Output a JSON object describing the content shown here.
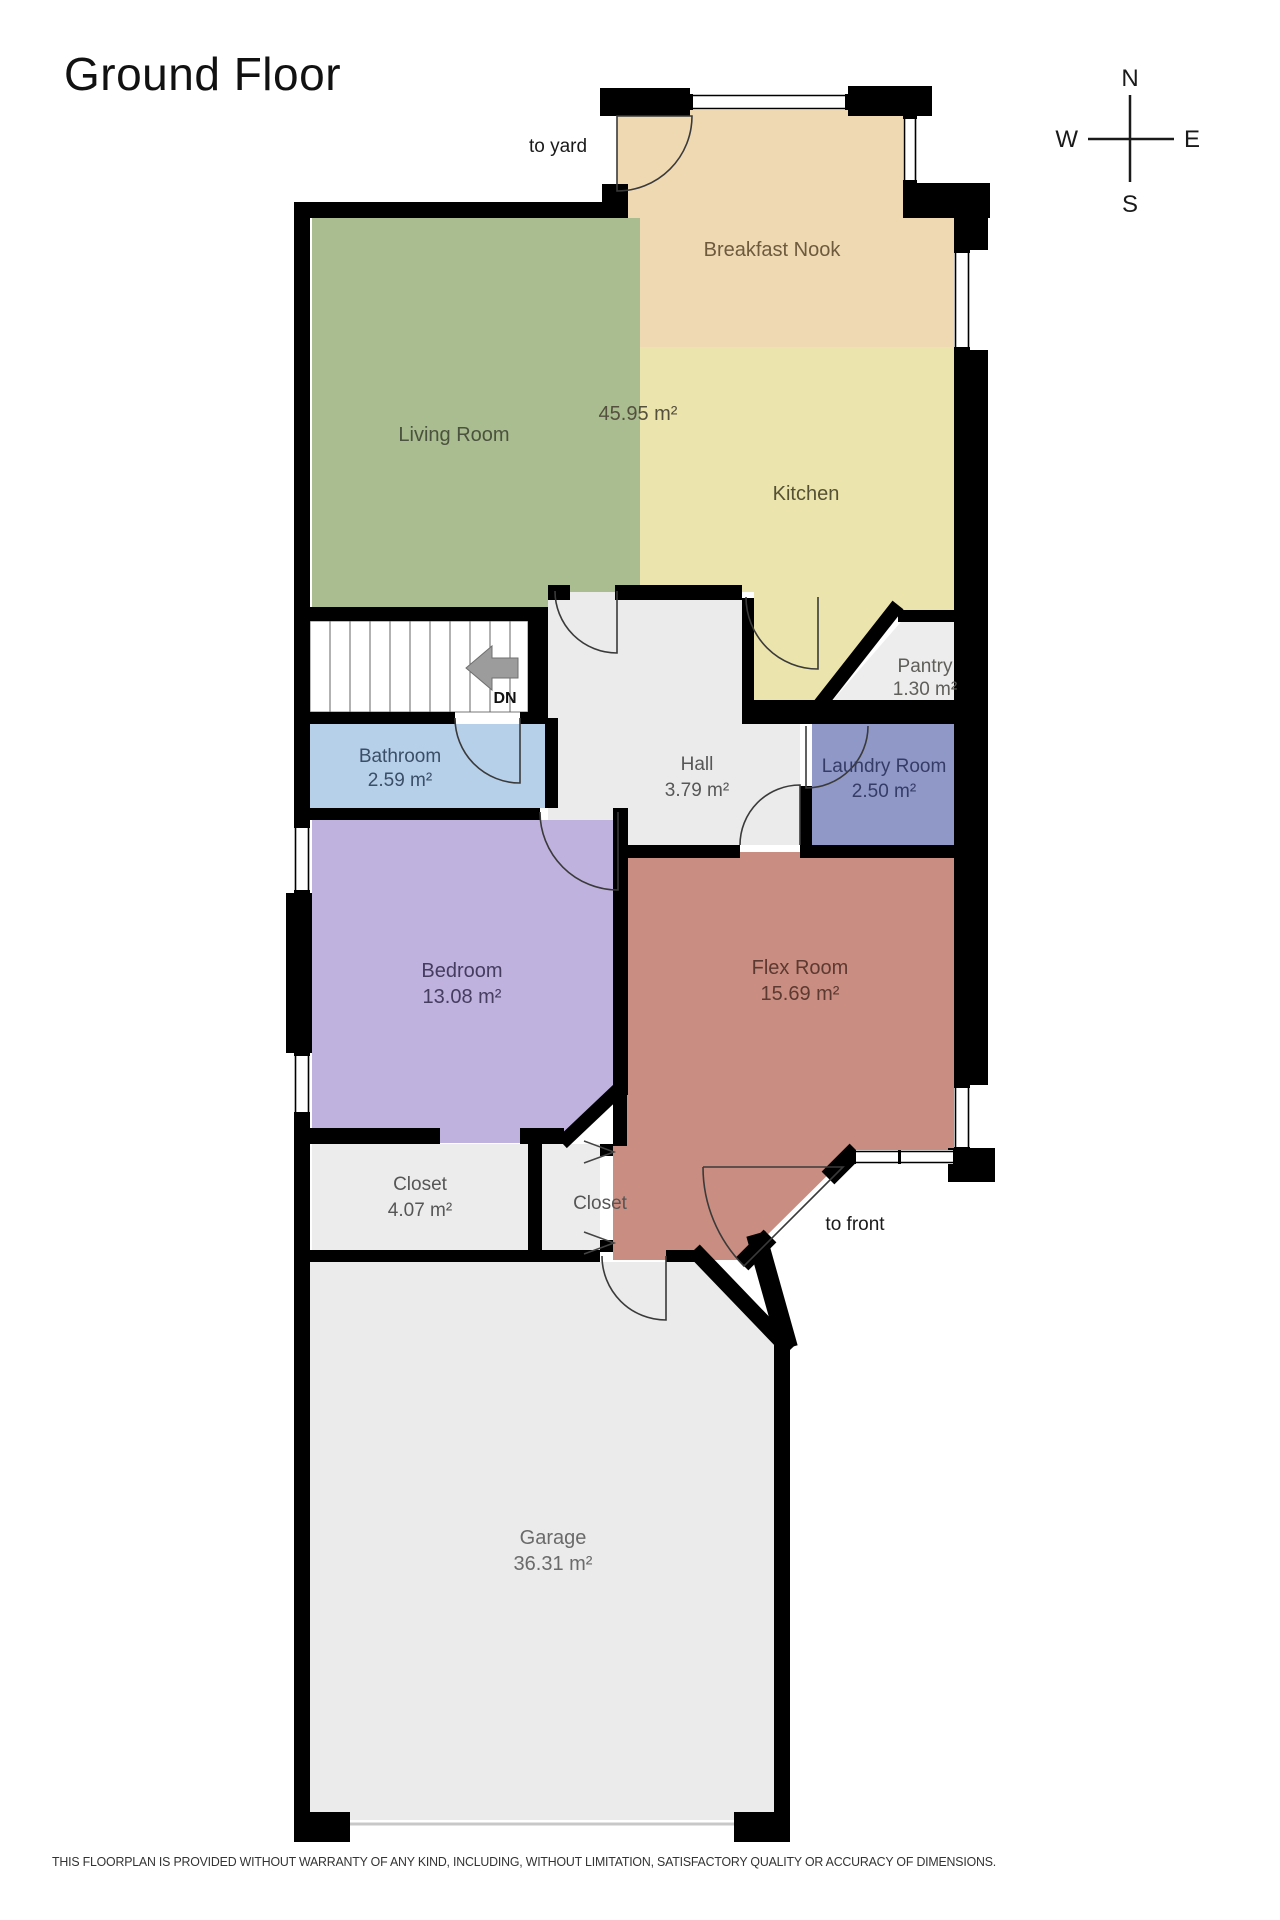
{
  "title": "Ground Floor",
  "compass": {
    "north": "N",
    "east": "E",
    "south": "S",
    "west": "W"
  },
  "annotations": {
    "to_yard": "to yard",
    "to_front": "to front"
  },
  "stairs": {
    "direction_label": "DN"
  },
  "living_kitchen_area": {
    "label": "45.95 m²",
    "color": "#55503e"
  },
  "rooms": [
    {
      "name": "Breakfast Nook",
      "area": "",
      "fill": "#eed9b3",
      "label_color": "#6e5a3d"
    },
    {
      "name": "Living Room",
      "area": "",
      "fill": "#a9bd90",
      "label_color": "#4b523d"
    },
    {
      "name": "Kitchen",
      "area": "",
      "fill": "#ece4ad",
      "label_color": "#565135"
    },
    {
      "name": "Pantry",
      "area": "1.30 m²",
      "fill": "#ededed",
      "label_color": "#5f5e59"
    },
    {
      "name": "Bathroom",
      "area": "2.59 m²",
      "fill": "#b7d0ea",
      "label_color": "#3a4e67"
    },
    {
      "name": "Hall",
      "area": "3.79 m²",
      "fill": "#ebebeb",
      "label_color": "#575757"
    },
    {
      "name": "Laundry Room",
      "area": "2.50 m²",
      "fill": "#8f98c6",
      "label_color": "#353c66"
    },
    {
      "name": "Bedroom",
      "area": "13.08 m²",
      "fill": "#c0b2de",
      "label_color": "#443d5f"
    },
    {
      "name": "Flex Room",
      "area": "15.69 m²",
      "fill": "#c98e81",
      "label_color": "#5c3931"
    },
    {
      "name": "Closet",
      "area": "4.07 m²",
      "fill": "#ececec",
      "label_color": "#565656"
    },
    {
      "name": "Closet",
      "area": "",
      "fill": "#ececec",
      "label_color": "#565656"
    },
    {
      "name": "Garage",
      "area": "36.31 m²",
      "fill": "#ebebeb",
      "label_color": "#6a6a6a"
    }
  ],
  "disclaimer": "THIS FLOORPLAN IS PROVIDED WITHOUT WARRANTY OF ANY KIND, INCLUDING, WITHOUT LIMITATION, SATISFACTORY QUALITY OR ACCURACY OF DIMENSIONS."
}
